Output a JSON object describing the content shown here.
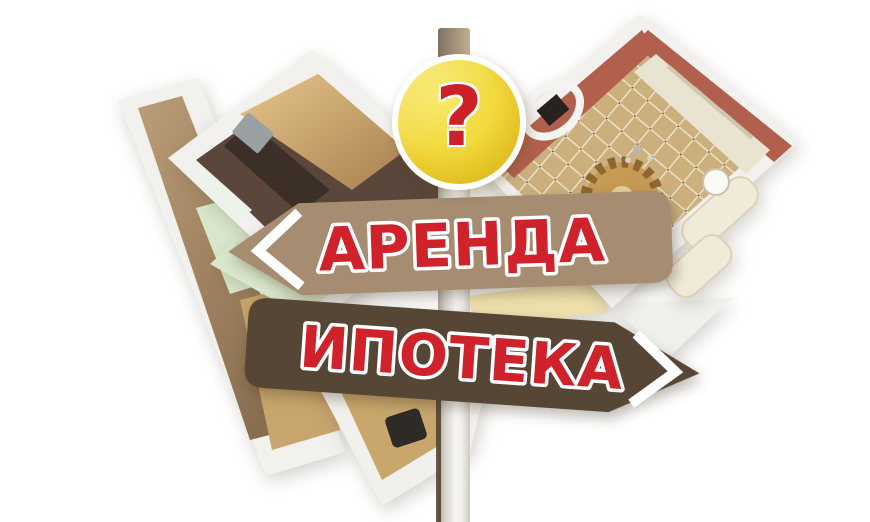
{
  "badge": {
    "symbol": "?",
    "symbol_color": "#cb2127",
    "fill_light": "#f7e45a",
    "fill_dark": "#d9b218",
    "ring_color": "#ffffff",
    "icon": "question-mark-icon"
  },
  "signs": [
    {
      "label": "АРЕНДА",
      "direction": "left",
      "board_color": "#a68c71",
      "label_color": "#d0222a",
      "outline_color": "#ffffff",
      "chevron_icon": "chevron-left-icon"
    },
    {
      "label": "ИПОТЕКА",
      "direction": "right",
      "board_color": "#564636",
      "label_color": "#d0222a",
      "outline_color": "#ffffff",
      "chevron_icon": "chevron-right-icon"
    }
  ],
  "pole": {
    "color_light": "#f7f6f4",
    "color_dark": "#a9a294"
  },
  "floorplan": {
    "wall_color": "#f2f1ee",
    "kitchen_color": "#5a463a",
    "cabinet_wood_color": "#c9a263",
    "corridor_floor_color": "#8a6f52",
    "mint_room_color": "#d9e8cc",
    "living_wall_color": "#b2604e",
    "curtain_color": "#e9e3d2",
    "parquet_color": "#cbb07e",
    "rug_color": "#c59a55",
    "sofa_color": "#f0ead9"
  }
}
